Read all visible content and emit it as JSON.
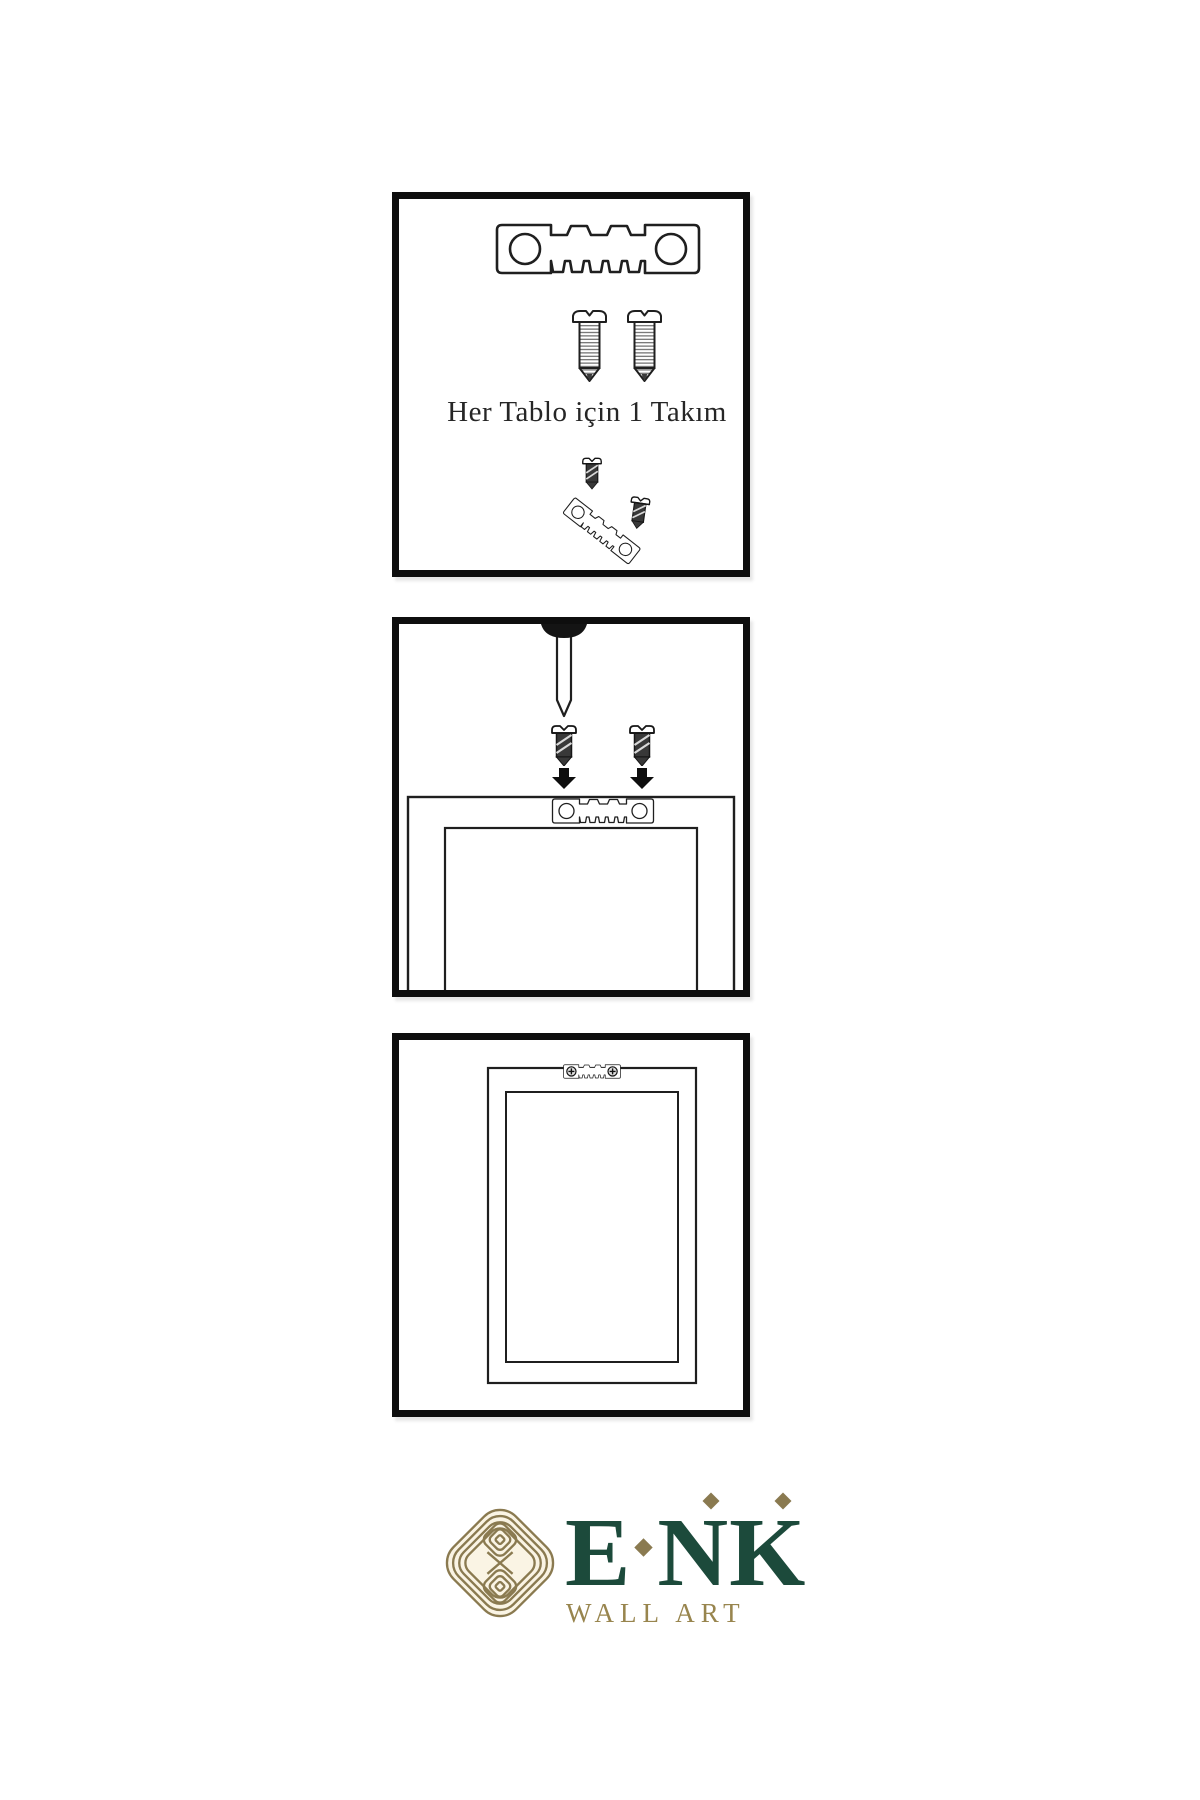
{
  "colors": {
    "background": "#ffffff",
    "line_art": "#1f1f1f",
    "panel_border": "#0e0e0e",
    "logo_green": "#1c4a3b",
    "logo_gold": "#8a7a50",
    "subtitle_gold": "#98854e",
    "emblem_cream": "#faf4e4"
  },
  "panels": {
    "kit": {
      "caption": "Her Tablo için 1 Takım",
      "icons": [
        "sawtooth-hanger-icon",
        "screw-icon",
        "screw-icon",
        "screw-into-hanger-icon"
      ]
    },
    "mounting": {
      "icons": [
        "nail-icon",
        "screw-icon",
        "screw-icon",
        "down-arrow-icon",
        "down-arrow-icon",
        "frame-back-icon",
        "sawtooth-hanger-icon"
      ]
    },
    "result": {
      "icons": [
        "frame-back-icon",
        "mounted-sawtooth-hanger-icon",
        "phillips-screw-icon",
        "phillips-screw-icon"
      ]
    }
  },
  "logo": {
    "letters": [
      "E",
      "N",
      "K"
    ],
    "subtitle": "WALL ART"
  }
}
